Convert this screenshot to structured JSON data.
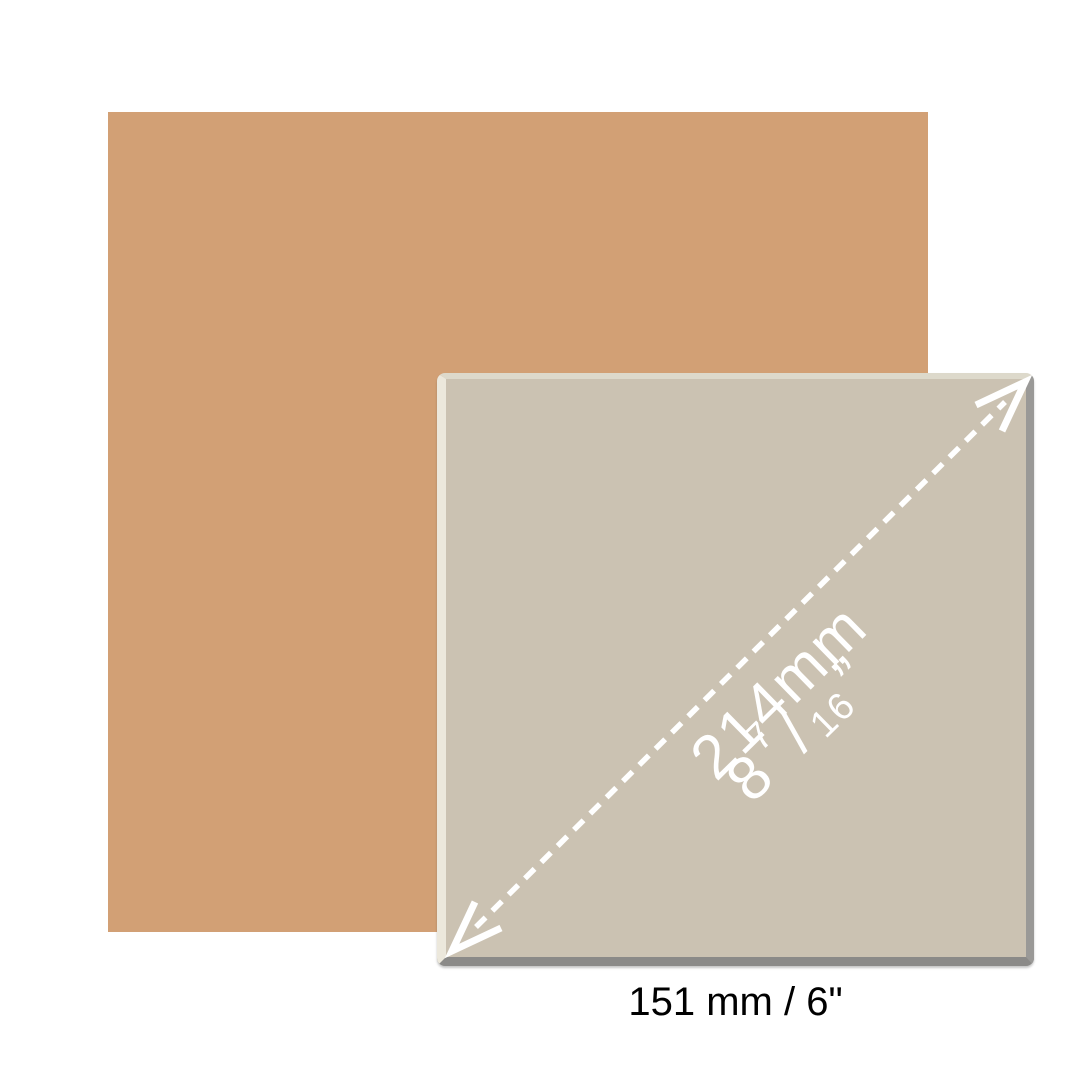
{
  "figure": {
    "swatch": {
      "color": "#d2a075"
    },
    "tile": {
      "face_color": "#cbc2b2",
      "highlight_color": "#ece8dc",
      "shadow_color": "#8b8a88",
      "diagonal_dimension": {
        "arrow_color": "#ffffff",
        "metric_label": "214mm",
        "imperial": {
          "whole": "8",
          "numerator": "7",
          "slash": "/",
          "denominator": "16",
          "unit": "”"
        }
      }
    },
    "caption": {
      "width_label": "151 mm / 6\"",
      "text_color": "#000000"
    }
  }
}
